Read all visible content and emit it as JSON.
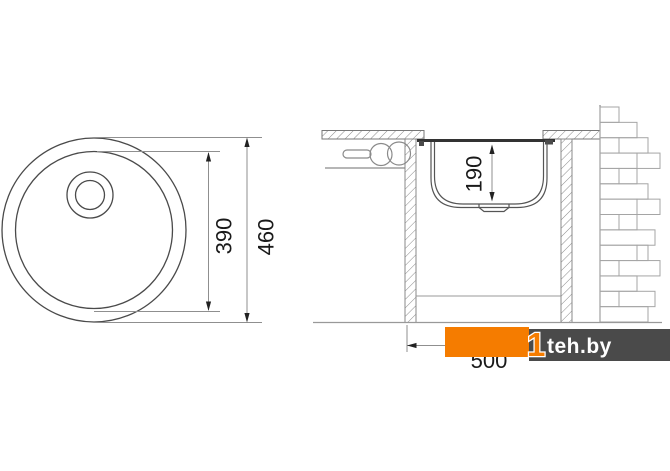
{
  "dimensions": {
    "top_view": {
      "bowl_diameter": "390",
      "overall_diameter": "460"
    },
    "section_view": {
      "bowl_depth": "190",
      "cabinet_width": "500"
    }
  },
  "watermark": {
    "mark": "1",
    "site": "teh.by",
    "orange": "#F57C00",
    "dark": "#4A4A4A"
  },
  "colors": {
    "background": "#FFFFFF",
    "line": "#4A4A4A",
    "dim_line": "#8F8F8F",
    "text": "#1A1A1A"
  }
}
